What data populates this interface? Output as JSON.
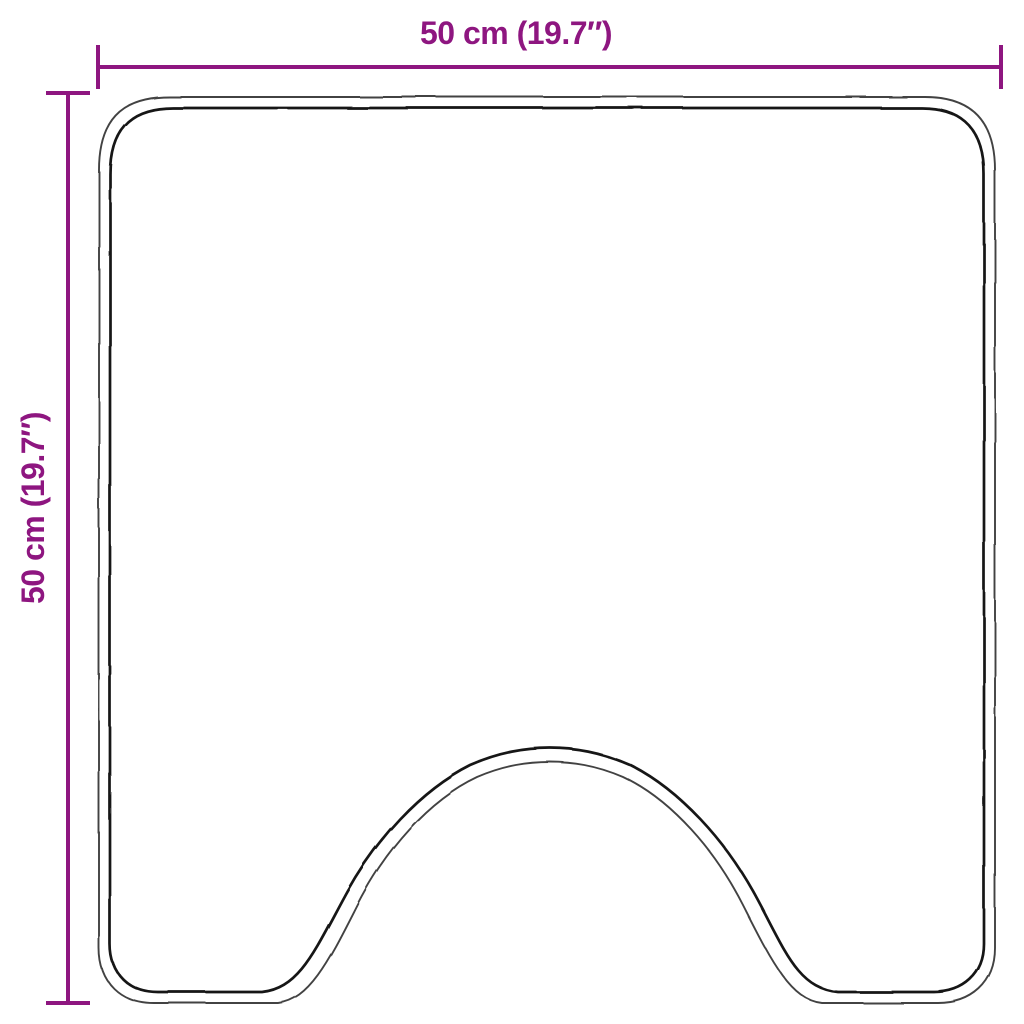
{
  "page": {
    "kind": "product-dimension-diagram",
    "background_color": "#ffffff"
  },
  "diagram": {
    "shape": "square mat with U-shaped pedestal cutout at bottom center",
    "accent_color": "#8e1680",
    "outline_outer_color": "#424242",
    "outline_inner_color": "#161616",
    "top_dimension": {
      "label": "50 cm (19.7″)"
    },
    "left_dimension": {
      "label": "50 cm (19.7″)"
    }
  }
}
